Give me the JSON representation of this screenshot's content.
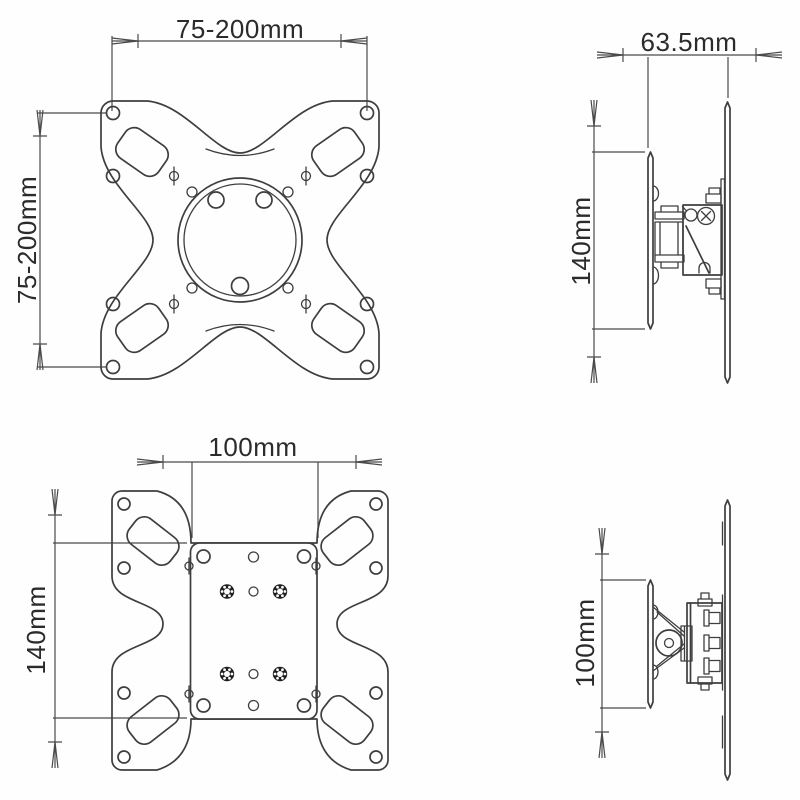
{
  "drawing": {
    "title_hint": "wall mount bracket dimension drawing",
    "colors": {
      "line": "#3e3e3e",
      "dimension_line": "#4a4a4a",
      "text": "#2b2b2b",
      "background": "#fefefe",
      "thread_hole": "#1f1f1f"
    },
    "views": {
      "front_top": {
        "width_label": "75-200mm",
        "height_label": "75-200mm"
      },
      "side_top": {
        "depth_label": "63.5mm",
        "height_label": "140mm"
      },
      "front_bottom": {
        "width_label": "100mm",
        "height_label": "140mm"
      },
      "side_bottom": {
        "height_label": "100mm"
      }
    }
  }
}
